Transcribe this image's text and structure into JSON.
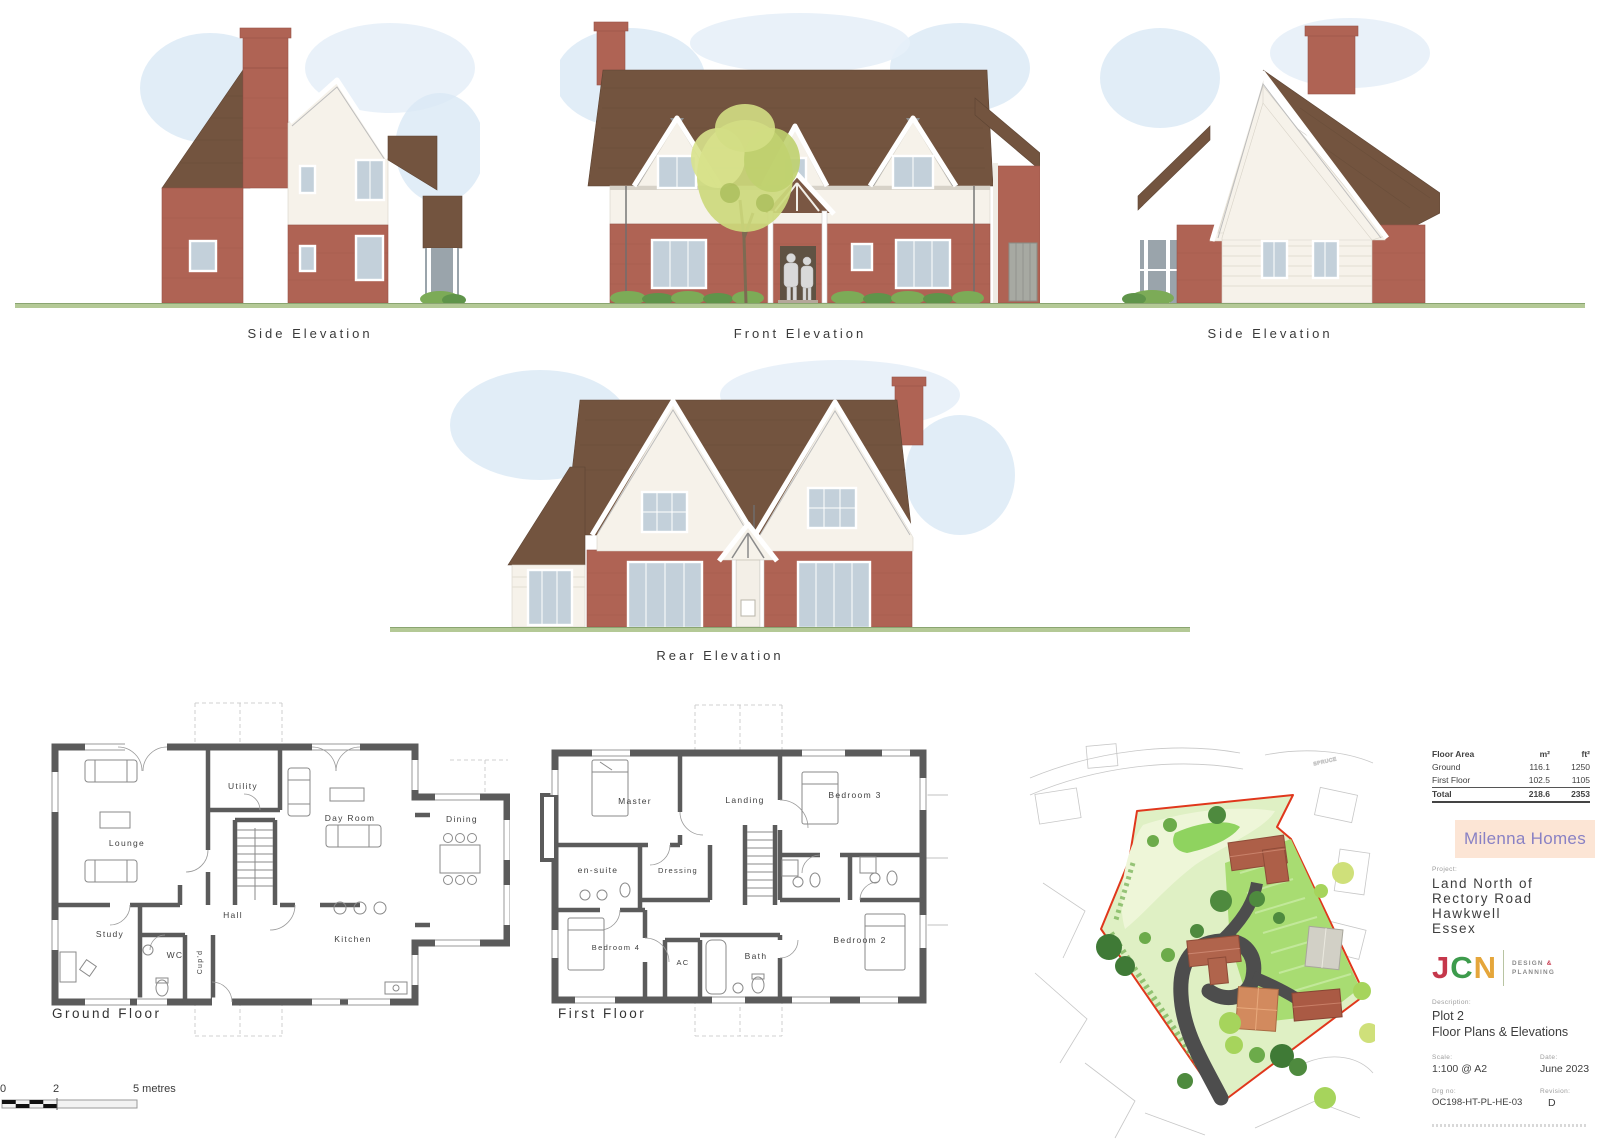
{
  "elevations": {
    "side_left": {
      "label": "Side Elevation"
    },
    "front": {
      "label": "Front Elevation"
    },
    "side_right": {
      "label": "Side Elevation"
    },
    "rear": {
      "label": "Rear Elevation"
    }
  },
  "floor_plans": {
    "ground": {
      "label": "Ground Floor",
      "rooms": [
        "Lounge",
        "Utility",
        "Day Room",
        "Dining",
        "Hall",
        "Study",
        "WC",
        "Cup'd",
        "Kitchen"
      ]
    },
    "first": {
      "label": "First Floor",
      "rooms": [
        "Master",
        "Landing",
        "Bedroom 3",
        "en-suite",
        "Dressing",
        "Bedroom 4",
        "AC",
        "Bath",
        "Bedroom 2"
      ]
    }
  },
  "scale_bar": {
    "label_0": "0",
    "label_2": "2",
    "label_5": "5 metres"
  },
  "site_plan": {
    "street_label": "SPRUCE",
    "boundary_color": "#e0371c"
  },
  "title_block": {
    "area_table": {
      "headers": [
        "Floor Area",
        "m²",
        "ft²"
      ],
      "rows": [
        [
          "Ground",
          "116.1",
          "1250"
        ],
        [
          "First Floor",
          "102.5",
          "1105"
        ],
        [
          "Total",
          "218.6",
          "2353"
        ]
      ]
    },
    "brand": {
      "name": "Milenna Homes",
      "bg": "#fce5d5",
      "color": "#8981c4"
    },
    "project": {
      "label": "Project:",
      "line1": "Land North of",
      "line2": "Rectory Road",
      "line3": "Hawkwell",
      "line4": "Essex"
    },
    "logo": {
      "letters": [
        {
          "char": "J",
          "color": "#c5374b"
        },
        {
          "char": "C",
          "color": "#3d9b4c"
        },
        {
          "char": "N",
          "color": "#e5a63b"
        }
      ],
      "tagline_design": "DESIGN",
      "tagline_amp": "&",
      "tagline_planning": "PLANNING"
    },
    "description": {
      "label": "Description:",
      "line1": "Plot 2",
      "line2": "Floor Plans & Elevations"
    },
    "scale": {
      "label": "Scale:",
      "value": "1:100 @ A2"
    },
    "date": {
      "label": "Date:",
      "value": "June 2023"
    },
    "drg_no": {
      "label": "Drg no:",
      "value": "OC198-HT-PL-HE-03"
    },
    "revision": {
      "label": "Revision:",
      "value": "D"
    }
  },
  "palette": {
    "roof_brown": "#73543f",
    "brick_red": "#af6354",
    "render_white": "#f6f2ea",
    "grass_green": "#b4c996",
    "tree_green": "#ccd97c"
  }
}
